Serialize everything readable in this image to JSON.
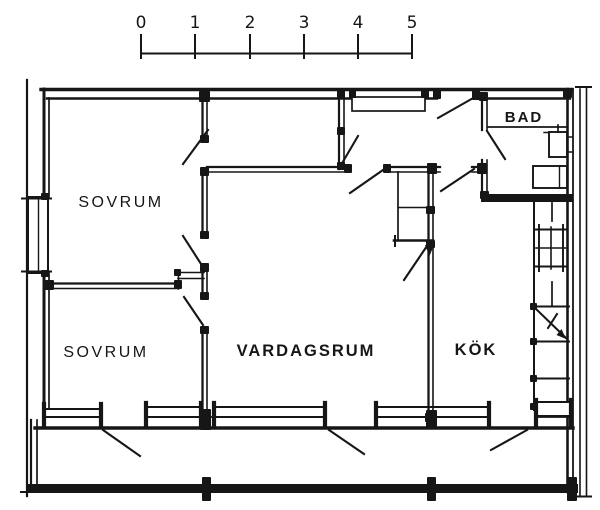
{
  "scale_bar": {
    "labels": [
      "0",
      "1",
      "2",
      "3",
      "4",
      "5"
    ]
  },
  "rooms": {
    "bedroom_top": {
      "label": "SOVRUM"
    },
    "bedroom_bottom": {
      "label": "SOVRUM"
    },
    "living_room": {
      "label": "VARDAGSRUM"
    },
    "kitchen": {
      "label": "KÖK"
    },
    "bathroom": {
      "label": "BAD"
    }
  },
  "colors": {
    "ink": "#161616",
    "paper": "#ffffff"
  }
}
